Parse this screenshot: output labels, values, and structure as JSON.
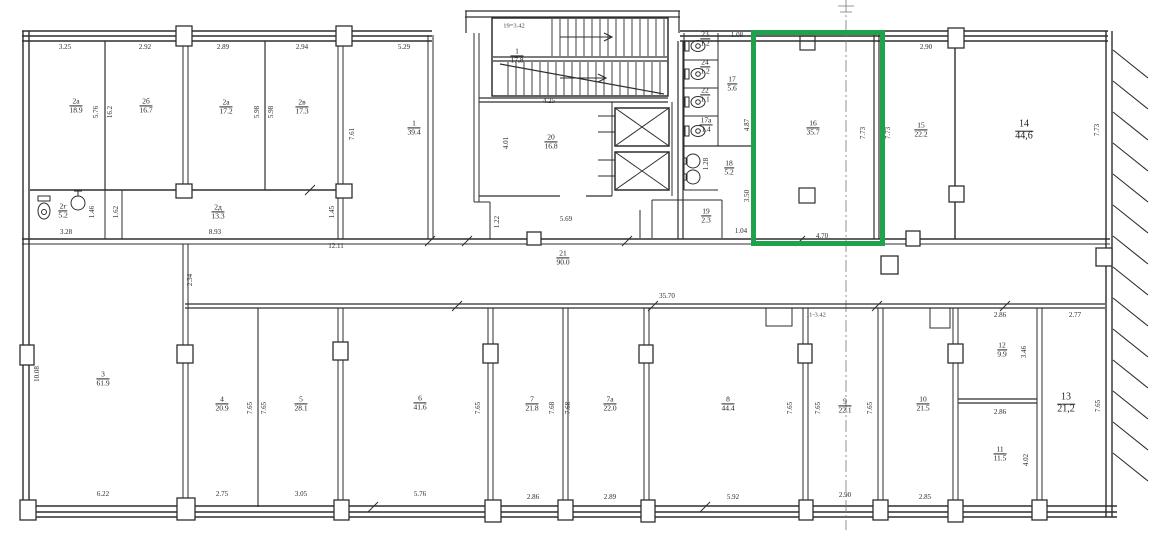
{
  "colors": {
    "highlight_green": "#1fa24c",
    "line": "#2e2e2e",
    "background": "#ffffff",
    "text": "#1b1b1b"
  },
  "highlighted_room": {
    "number": "16",
    "area": "35.7"
  },
  "plan": {
    "rooms": [
      {
        "num": "2а",
        "area": "18.9",
        "x": 76,
        "y": 106
      },
      {
        "num": "2б",
        "area": "16.7",
        "x": 146,
        "y": 106
      },
      {
        "num": "2а",
        "area": "17.2",
        "x": 226,
        "y": 107
      },
      {
        "num": "2в",
        "area": "17.3",
        "x": 302,
        "y": 107
      },
      {
        "num": "2г",
        "area": "5.2",
        "x": 63,
        "y": 211
      },
      {
        "num": "2д",
        "area": "13.3",
        "x": 218,
        "y": 212
      },
      {
        "num": "1",
        "area": "39.4",
        "x": 414,
        "y": 128
      },
      {
        "num": "1",
        "area": "17,8",
        "x": 517,
        "y": 56
      },
      {
        "num": "20",
        "area": "16.8",
        "x": 551,
        "y": 142
      },
      {
        "num": "21",
        "area": "90.0",
        "x": 563,
        "y": 258
      },
      {
        "num": "23",
        "area": "1.2",
        "x": 705,
        "y": 39
      },
      {
        "num": "24",
        "area": "1.2",
        "x": 705,
        "y": 67
      },
      {
        "num": "22",
        "area": "1.1",
        "x": 705,
        "y": 95
      },
      {
        "num": "17а",
        "area": "1.4",
        "x": 706,
        "y": 125
      },
      {
        "num": "17",
        "area": "5.6",
        "x": 732,
        "y": 84
      },
      {
        "num": "18",
        "area": "5.2",
        "x": 729,
        "y": 168
      },
      {
        "num": "19",
        "area": "2.3",
        "x": 706,
        "y": 216
      },
      {
        "num": "16",
        "area": "35.7",
        "x": 813,
        "y": 128
      },
      {
        "num": "15",
        "area": "22.2",
        "x": 921,
        "y": 130
      },
      {
        "num": "14",
        "area": "44,6",
        "x": 1024,
        "y": 131,
        "big": true
      },
      {
        "num": "3",
        "area": "61.9",
        "x": 103,
        "y": 379
      },
      {
        "num": "4",
        "area": "20.9",
        "x": 222,
        "y": 404
      },
      {
        "num": "5",
        "area": "28.1",
        "x": 301,
        "y": 404
      },
      {
        "num": "6",
        "area": "41.6",
        "x": 420,
        "y": 403
      },
      {
        "num": "7",
        "area": "21.8",
        "x": 532,
        "y": 404
      },
      {
        "num": "7а",
        "area": "22.0",
        "x": 610,
        "y": 404
      },
      {
        "num": "8",
        "area": "44.4",
        "x": 728,
        "y": 404
      },
      {
        "num": "9",
        "area": "22.1",
        "x": 845,
        "y": 406
      },
      {
        "num": "10",
        "area": "21.5",
        "x": 923,
        "y": 404
      },
      {
        "num": "12",
        "area": "9.9",
        "x": 1002,
        "y": 350
      },
      {
        "num": "11",
        "area": "11.5",
        "x": 1000,
        "y": 454
      },
      {
        "num": "13",
        "area": "21,2",
        "x": 1066,
        "y": 404,
        "big": true
      }
    ],
    "dimensions": [
      {
        "text": "3.25",
        "x": 65,
        "y": 47
      },
      {
        "text": "2.92",
        "x": 145,
        "y": 47
      },
      {
        "text": "2.89",
        "x": 223,
        "y": 47
      },
      {
        "text": "2.94",
        "x": 302,
        "y": 47
      },
      {
        "text": "5.29",
        "x": 404,
        "y": 47
      },
      {
        "text": "5.76",
        "x": 96,
        "y": 112,
        "rot": true
      },
      {
        "text": "16.2",
        "x": 110,
        "y": 112,
        "rot": true
      },
      {
        "text": "5.98",
        "x": 257,
        "y": 112,
        "rot": true
      },
      {
        "text": "5.98",
        "x": 271,
        "y": 112,
        "rot": true
      },
      {
        "text": "7.61",
        "x": 352,
        "y": 134,
        "rot": true
      },
      {
        "text": "1.46",
        "x": 92,
        "y": 212,
        "rot": true
      },
      {
        "text": "1.62",
        "x": 116,
        "y": 212,
        "rot": true
      },
      {
        "text": "1.45",
        "x": 332,
        "y": 212,
        "rot": true
      },
      {
        "text": "3.28",
        "x": 66,
        "y": 232
      },
      {
        "text": "8.93",
        "x": 215,
        "y": 232
      },
      {
        "text": "12.11",
        "x": 336,
        "y": 246
      },
      {
        "text": "4.25",
        "x": 549,
        "y": 101
      },
      {
        "text": "4.01",
        "x": 506,
        "y": 143,
        "rot": true
      },
      {
        "text": "5.69",
        "x": 566,
        "y": 219
      },
      {
        "text": "1.22",
        "x": 497,
        "y": 222,
        "rot": true
      },
      {
        "text": "1.08",
        "x": 737,
        "y": 35
      },
      {
        "text": "4.87",
        "x": 747,
        "y": 125,
        "rot": true
      },
      {
        "text": "1.28",
        "x": 706,
        "y": 164,
        "rot": true
      },
      {
        "text": "3.50",
        "x": 747,
        "y": 196,
        "rot": true
      },
      {
        "text": "1.04",
        "x": 741,
        "y": 231
      },
      {
        "text": "4.70",
        "x": 822,
        "y": 236
      },
      {
        "text": "7.73",
        "x": 863,
        "y": 133,
        "rot": true
      },
      {
        "text": "7.73",
        "x": 888,
        "y": 133,
        "rot": true
      },
      {
        "text": "2.90",
        "x": 926,
        "y": 47
      },
      {
        "text": "7.73",
        "x": 1097,
        "y": 130,
        "rot": true
      },
      {
        "text": "35.70",
        "x": 667,
        "y": 296
      },
      {
        "text": "10.08",
        "x": 37,
        "y": 374,
        "rot": true
      },
      {
        "text": "2.34",
        "x": 190,
        "y": 280,
        "rot": true
      },
      {
        "text": "6.22",
        "x": 103,
        "y": 494
      },
      {
        "text": "2.75",
        "x": 222,
        "y": 494
      },
      {
        "text": "3.05",
        "x": 301,
        "y": 494
      },
      {
        "text": "5.76",
        "x": 420,
        "y": 494
      },
      {
        "text": "2.86",
        "x": 533,
        "y": 497
      },
      {
        "text": "2.89",
        "x": 610,
        "y": 497
      },
      {
        "text": "5.92",
        "x": 733,
        "y": 497
      },
      {
        "text": "2.90",
        "x": 845,
        "y": 495
      },
      {
        "text": "2.85",
        "x": 925,
        "y": 497
      },
      {
        "text": "7.65",
        "x": 250,
        "y": 408,
        "rot": true
      },
      {
        "text": "7.65",
        "x": 264,
        "y": 408,
        "rot": true
      },
      {
        "text": "7.65",
        "x": 478,
        "y": 408,
        "rot": true
      },
      {
        "text": "7.68",
        "x": 552,
        "y": 408,
        "rot": true
      },
      {
        "text": "7.68",
        "x": 568,
        "y": 408,
        "rot": true
      },
      {
        "text": "7.65",
        "x": 790,
        "y": 408,
        "rot": true
      },
      {
        "text": "7.65",
        "x": 818,
        "y": 408,
        "rot": true
      },
      {
        "text": "7.65",
        "x": 870,
        "y": 408,
        "rot": true
      },
      {
        "text": "2.86",
        "x": 1000,
        "y": 315
      },
      {
        "text": "2.86",
        "x": 1000,
        "y": 412
      },
      {
        "text": "3.46",
        "x": 1024,
        "y": 352,
        "rot": true
      },
      {
        "text": "4.02",
        "x": 1026,
        "y": 460,
        "rot": true
      },
      {
        "text": "2.77",
        "x": 1075,
        "y": 315
      },
      {
        "text": "7.65",
        "x": 1098,
        "y": 406,
        "rot": true
      }
    ],
    "annotations": [
      {
        "text": "19=3.42",
        "x": 514,
        "y": 26
      },
      {
        "text": "11-3.42",
        "x": 816,
        "y": 315
      }
    ]
  }
}
